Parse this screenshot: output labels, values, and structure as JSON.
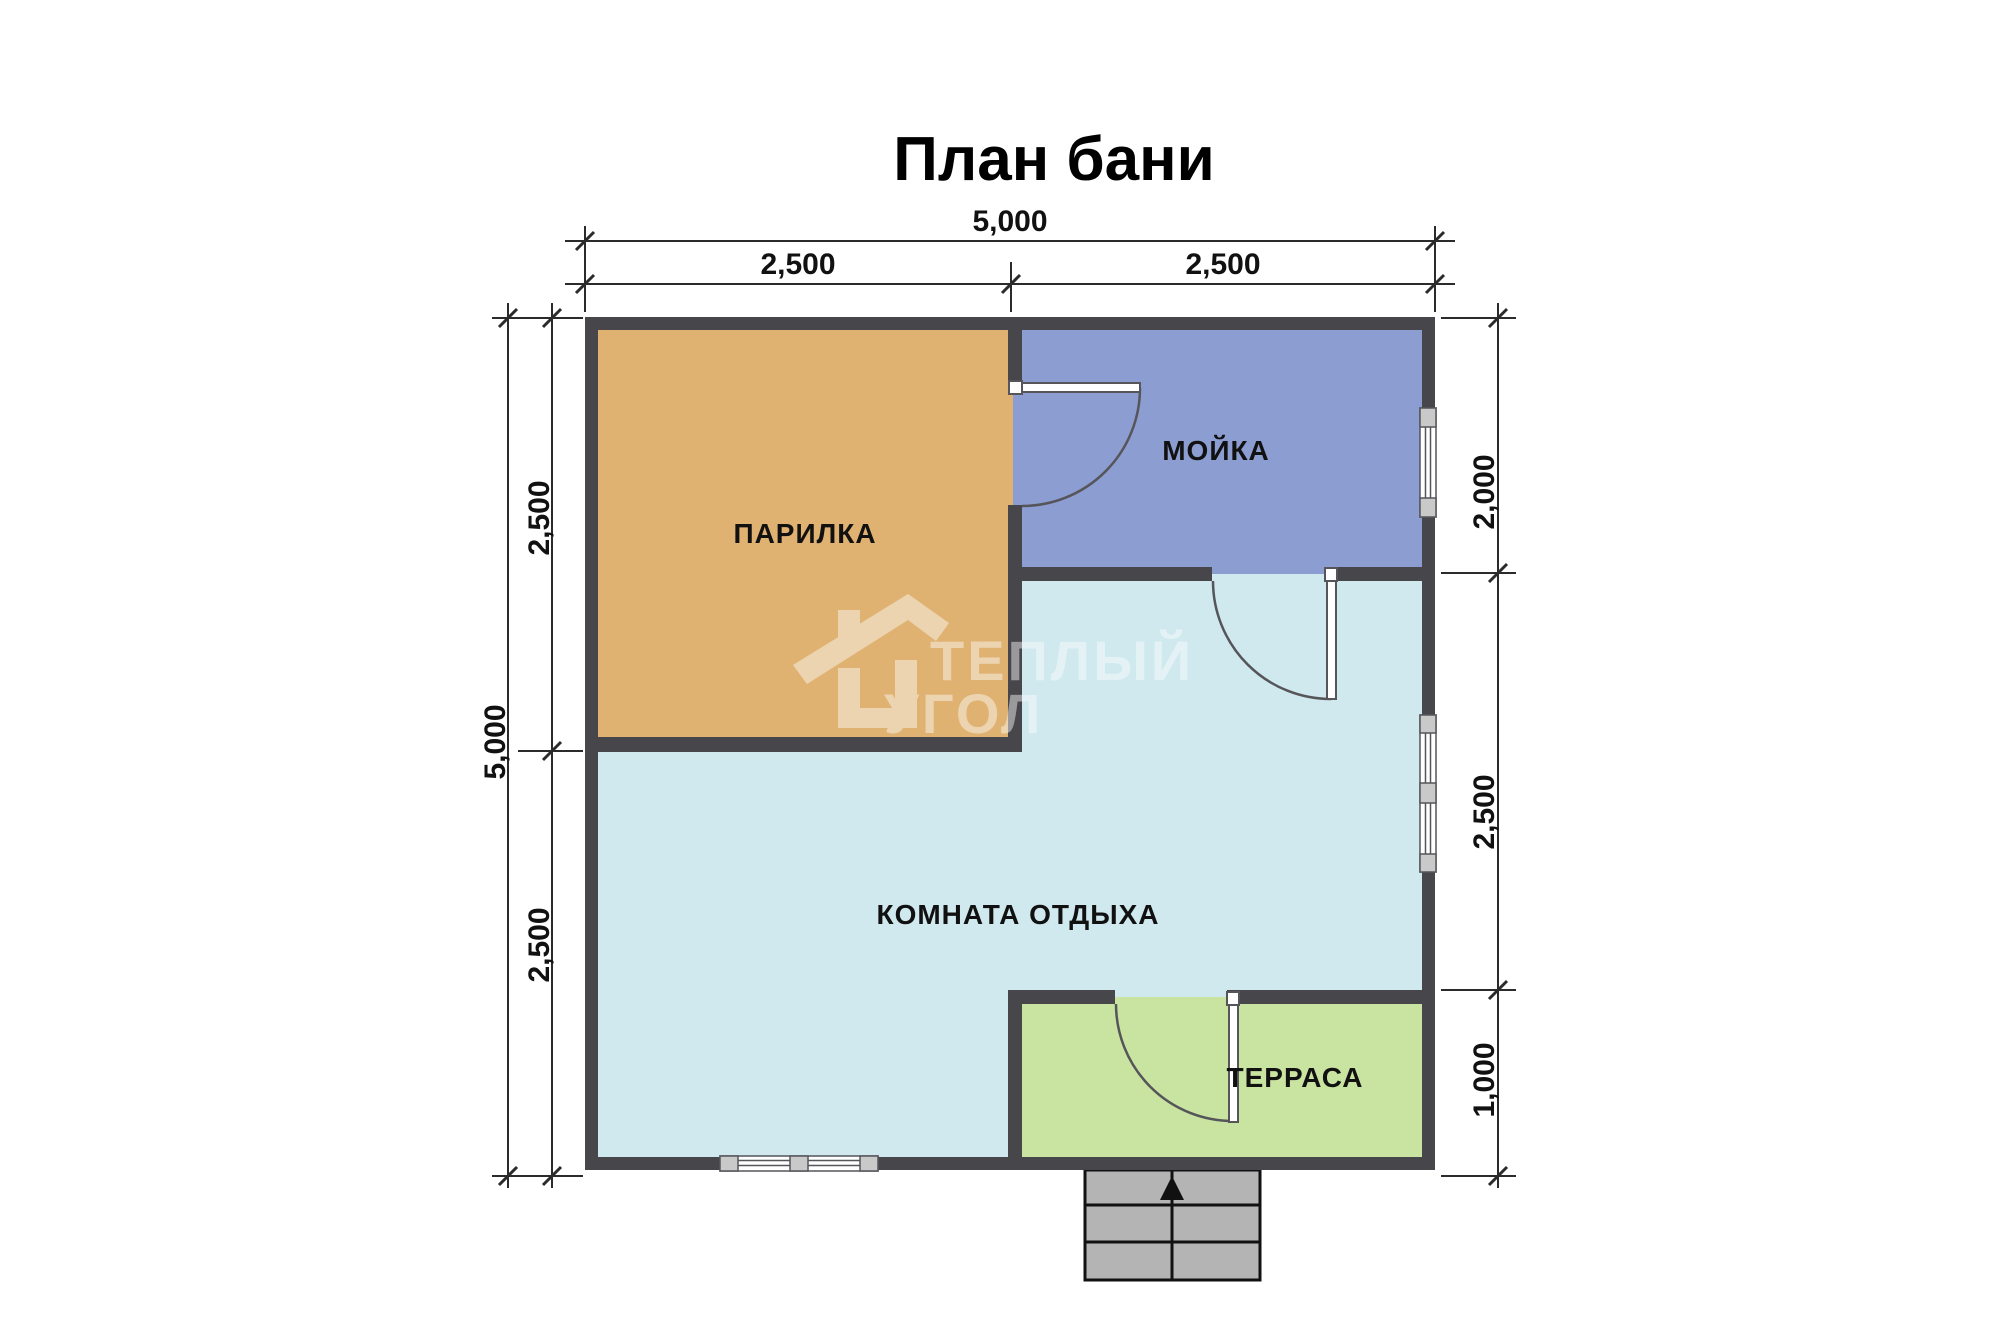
{
  "title": "План бани",
  "rooms": {
    "parilka": {
      "label": "ПАРИЛКА",
      "color": "#DFB272"
    },
    "moyka": {
      "label": "МОЙКА",
      "color": "#8C9DD2"
    },
    "komnata": {
      "label": "КОМНАТА ОТДЫХА",
      "color": "#CFE9EE"
    },
    "terrasa": {
      "label": "ТЕРРАСА",
      "color": "#C9E3A1"
    }
  },
  "dimensions": {
    "top_total": "5,000",
    "top_left": "2,500",
    "top_right": "2,500",
    "left_total": "5,000",
    "left_upper": "2,500",
    "left_lower": "2,500",
    "right_upper": "2,000",
    "right_middle": "2,500",
    "right_lower": "1,000"
  },
  "watermark": {
    "line1": "ТЕПЛЫЙ",
    "line2": "УГОЛ"
  },
  "colors": {
    "wall": "#47474B",
    "stairs": "#B4B4B4",
    "window_frame": "#C9C9C9",
    "dim_line": "#2B2B2B",
    "door_arc": "#4A4A4E"
  }
}
